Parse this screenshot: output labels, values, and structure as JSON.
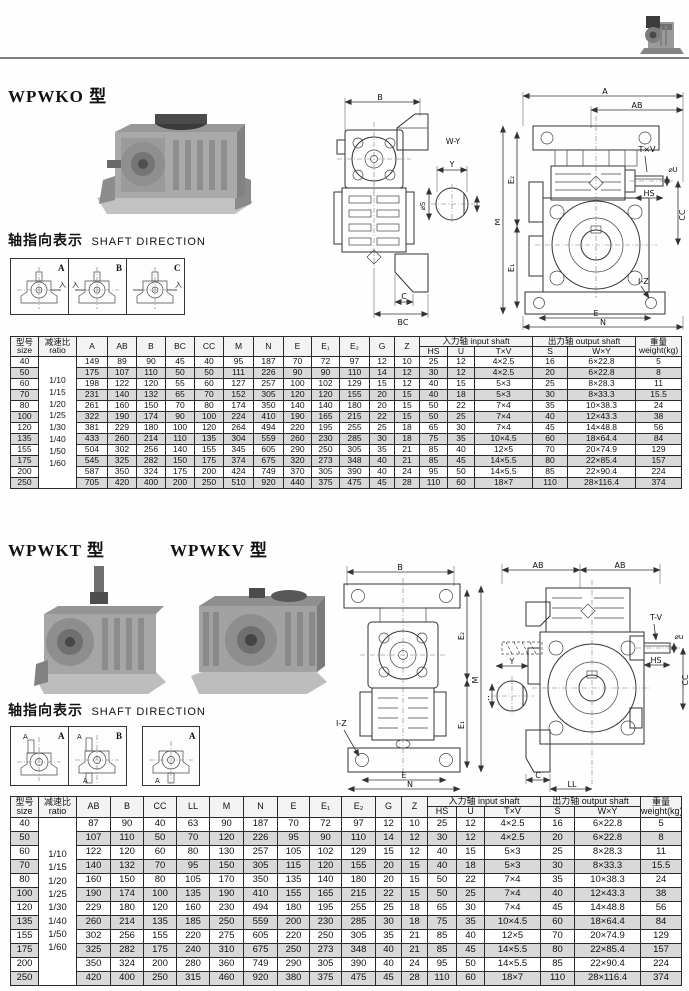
{
  "titles": {
    "wpwko": "WPWKO 型",
    "wpwkt": "WPWKT 型",
    "wpwkv": "WPWKV 型"
  },
  "shaft_direction1": {
    "cn": "轴指向表示",
    "en": "SHAFT DIRECTION",
    "panels": [
      "A",
      "B",
      "C"
    ],
    "mark": "入"
  },
  "shaft_direction2": {
    "cn": "轴指向表示",
    "en": "SHAFT DIRECTION",
    "panels": [
      "A",
      "B",
      "A"
    ],
    "mark": "A"
  },
  "drawings": {
    "front1": {
      "b": "B",
      "c": "C",
      "bc": "BC",
      "wy": "W-Y",
      "y": "Y",
      "s": "⌀S"
    },
    "side1": {
      "a": "A",
      "ab": "AB",
      "m": "M",
      "e2": "E₂",
      "e1": "E₁",
      "tv": "T×V",
      "u": "⌀U",
      "hs": "HS",
      "cc": "CC",
      "iz": "I-Z",
      "e": "E",
      "n": "N"
    },
    "front2": {
      "b": "B",
      "m": "M",
      "e2": "E₂",
      "e1": "E₁",
      "iz": "I-Z",
      "e": "E",
      "n": "N"
    },
    "side2": {
      "ab1": "AB",
      "ab2": "AB",
      "tv": "T-V",
      "u": "⌀u",
      "hs": "HS",
      "cc": "CC",
      "y": "Y",
      "w": "W",
      "c": "C",
      "ll": "LL"
    }
  },
  "table1": {
    "col_widths": [
      28,
      38,
      31,
      29,
      29,
      29,
      29,
      30,
      30,
      28,
      28,
      30,
      25,
      25,
      28,
      27,
      58,
      35,
      68,
      46
    ],
    "header": [
      [
        {
          "t": "型号\nsize",
          "rs": 2
        },
        {
          "t": "减速比\nratio",
          "rs": 2
        },
        {
          "t": "A",
          "rs": 2
        },
        {
          "t": "AB",
          "rs": 2
        },
        {
          "t": "B",
          "rs": 2
        },
        {
          "t": "BC",
          "rs": 2
        },
        {
          "t": "CC",
          "rs": 2
        },
        {
          "t": "M",
          "rs": 2
        },
        {
          "t": "N",
          "rs": 2
        },
        {
          "t": "E",
          "rs": 2
        },
        {
          "t": "E₁",
          "rs": 2
        },
        {
          "t": "E₂",
          "rs": 2
        },
        {
          "t": "G",
          "rs": 2
        },
        {
          "t": "Z",
          "rs": 2
        },
        {
          "t": "入力轴 input shaft",
          "cs": 3
        },
        {
          "t": "出力轴 output shaft",
          "cs": 2
        },
        {
          "t": "重量\nweight(kg)",
          "rs": 2
        }
      ],
      [
        {
          "t": "HS"
        },
        {
          "t": "U"
        },
        {
          "t": "T×V"
        },
        {
          "t": "S"
        },
        {
          "t": "W×Y"
        }
      ]
    ],
    "ratios": [
      "1/10",
      "1/15",
      "1/20",
      "1/25",
      "1/30",
      "1/40",
      "1/50",
      "1/60"
    ],
    "rows": [
      [
        "40",
        "149",
        "89",
        "90",
        "45",
        "40",
        "95",
        "187",
        "70",
        "72",
        "97",
        "12",
        "10",
        "25",
        "12",
        "4×2.5",
        "16",
        "6×22.8",
        "5"
      ],
      [
        "50",
        "175",
        "107",
        "110",
        "50",
        "50",
        "111",
        "226",
        "90",
        "90",
        "110",
        "14",
        "12",
        "30",
        "12",
        "4×2.5",
        "20",
        "6×22.8",
        "8"
      ],
      [
        "60",
        "198",
        "122",
        "120",
        "55",
        "60",
        "127",
        "257",
        "100",
        "102",
        "129",
        "15",
        "12",
        "40",
        "15",
        "5×3",
        "25",
        "8×28.3",
        "11"
      ],
      [
        "70",
        "231",
        "140",
        "132",
        "65",
        "70",
        "152",
        "305",
        "120",
        "120",
        "155",
        "20",
        "15",
        "40",
        "18",
        "5×3",
        "30",
        "8×33.3",
        "15.5"
      ],
      [
        "80",
        "261",
        "160",
        "150",
        "70",
        "80",
        "174",
        "350",
        "140",
        "140",
        "180",
        "20",
        "15",
        "50",
        "22",
        "7×4",
        "35",
        "10×38.3",
        "24"
      ],
      [
        "100",
        "322",
        "190",
        "174",
        "90",
        "100",
        "224",
        "410",
        "190",
        "165",
        "215",
        "22",
        "15",
        "50",
        "25",
        "7×4",
        "40",
        "12×43.3",
        "38"
      ],
      [
        "120",
        "381",
        "229",
        "180",
        "100",
        "120",
        "264",
        "494",
        "220",
        "195",
        "255",
        "25",
        "18",
        "65",
        "30",
        "7×4",
        "45",
        "14×48.8",
        "56"
      ],
      [
        "135",
        "433",
        "260",
        "214",
        "110",
        "135",
        "304",
        "559",
        "260",
        "230",
        "285",
        "30",
        "18",
        "75",
        "35",
        "10×4.5",
        "60",
        "18×64.4",
        "84"
      ],
      [
        "155",
        "504",
        "302",
        "256",
        "140",
        "155",
        "345",
        "605",
        "290",
        "250",
        "305",
        "35",
        "21",
        "85",
        "40",
        "12×5",
        "70",
        "20×74.9",
        "129"
      ],
      [
        "175",
        "545",
        "325",
        "282",
        "150",
        "175",
        "374",
        "675",
        "320",
        "273",
        "348",
        "40",
        "21",
        "85",
        "45",
        "14×5.5",
        "80",
        "22×85.4",
        "157"
      ],
      [
        "200",
        "587",
        "350",
        "324",
        "175",
        "200",
        "424",
        "749",
        "370",
        "305",
        "390",
        "40",
        "24",
        "95",
        "50",
        "14×5.5",
        "85",
        "22×90.4",
        "224"
      ],
      [
        "250",
        "705",
        "420",
        "400",
        "200",
        "250",
        "510",
        "920",
        "440",
        "375",
        "475",
        "45",
        "28",
        "110",
        "60",
        "18×7",
        "110",
        "28×116.4",
        "374"
      ]
    ]
  },
  "table2": {
    "col_widths": [
      28,
      38,
      34,
      33,
      33,
      33,
      34,
      34,
      32,
      32,
      34,
      26,
      26,
      29,
      28,
      56,
      34,
      66,
      41
    ],
    "header": [
      [
        {
          "t": "型号\nsize",
          "rs": 2
        },
        {
          "t": "减速比\nratio",
          "rs": 2
        },
        {
          "t": "AB",
          "rs": 2
        },
        {
          "t": "B",
          "rs": 2
        },
        {
          "t": "CC",
          "rs": 2
        },
        {
          "t": "LL",
          "rs": 2
        },
        {
          "t": "M",
          "rs": 2
        },
        {
          "t": "N",
          "rs": 2
        },
        {
          "t": "E",
          "rs": 2
        },
        {
          "t": "E₁",
          "rs": 2
        },
        {
          "t": "E₂",
          "rs": 2
        },
        {
          "t": "G",
          "rs": 2
        },
        {
          "t": "Z",
          "rs": 2
        },
        {
          "t": "入力轴 input shaft",
          "cs": 3
        },
        {
          "t": "出力轴 output shaft",
          "cs": 2
        },
        {
          "t": "重量\nweight(kg)",
          "rs": 2
        }
      ],
      [
        {
          "t": "HS"
        },
        {
          "t": "U"
        },
        {
          "t": "T×V"
        },
        {
          "t": "S"
        },
        {
          "t": "W×Y"
        }
      ]
    ],
    "ratios": [
      "1/10",
      "1/15",
      "1/20",
      "1/25",
      "1/30",
      "1/40",
      "1/50",
      "1/60"
    ],
    "rows": [
      [
        "40",
        "87",
        "90",
        "40",
        "63",
        "90",
        "187",
        "70",
        "72",
        "97",
        "12",
        "10",
        "25",
        "12",
        "4×2.5",
        "16",
        "6×22.8",
        "5"
      ],
      [
        "50",
        "107",
        "110",
        "50",
        "70",
        "120",
        "226",
        "95",
        "90",
        "110",
        "14",
        "12",
        "30",
        "12",
        "4×2.5",
        "20",
        "6×22.8",
        "8"
      ],
      [
        "60",
        "122",
        "120",
        "60",
        "80",
        "130",
        "257",
        "105",
        "102",
        "129",
        "15",
        "12",
        "40",
        "15",
        "5×3",
        "25",
        "8×28.3",
        "11"
      ],
      [
        "70",
        "140",
        "132",
        "70",
        "95",
        "150",
        "305",
        "115",
        "120",
        "155",
        "20",
        "15",
        "40",
        "18",
        "5×3",
        "30",
        "8×33.3",
        "15.5"
      ],
      [
        "80",
        "160",
        "150",
        "80",
        "105",
        "170",
        "350",
        "135",
        "140",
        "180",
        "20",
        "15",
        "50",
        "22",
        "7×4",
        "35",
        "10×38.3",
        "24"
      ],
      [
        "100",
        "190",
        "174",
        "100",
        "135",
        "190",
        "410",
        "155",
        "165",
        "215",
        "22",
        "15",
        "50",
        "25",
        "7×4",
        "40",
        "12×43.3",
        "38"
      ],
      [
        "120",
        "229",
        "180",
        "120",
        "160",
        "230",
        "494",
        "180",
        "195",
        "255",
        "25",
        "18",
        "65",
        "30",
        "7×4",
        "45",
        "14×48.8",
        "56"
      ],
      [
        "135",
        "260",
        "214",
        "135",
        "185",
        "250",
        "559",
        "200",
        "230",
        "285",
        "30",
        "18",
        "75",
        "35",
        "10×4.5",
        "60",
        "18×64.4",
        "84"
      ],
      [
        "155",
        "302",
        "256",
        "155",
        "220",
        "275",
        "605",
        "220",
        "250",
        "305",
        "35",
        "21",
        "85",
        "40",
        "12×5",
        "70",
        "20×74.9",
        "129"
      ],
      [
        "175",
        "325",
        "282",
        "175",
        "240",
        "310",
        "675",
        "250",
        "273",
        "348",
        "40",
        "21",
        "85",
        "45",
        "14×5.5",
        "80",
        "22×85.4",
        "157"
      ],
      [
        "200",
        "350",
        "324",
        "200",
        "280",
        "360",
        "749",
        "290",
        "305",
        "390",
        "40",
        "24",
        "95",
        "50",
        "14×5.5",
        "85",
        "22×90.4",
        "224"
      ],
      [
        "250",
        "420",
        "400",
        "250",
        "315",
        "460",
        "920",
        "380",
        "375",
        "475",
        "45",
        "28",
        "110",
        "60",
        "18×7",
        "110",
        "28×116.4",
        "374"
      ]
    ]
  }
}
